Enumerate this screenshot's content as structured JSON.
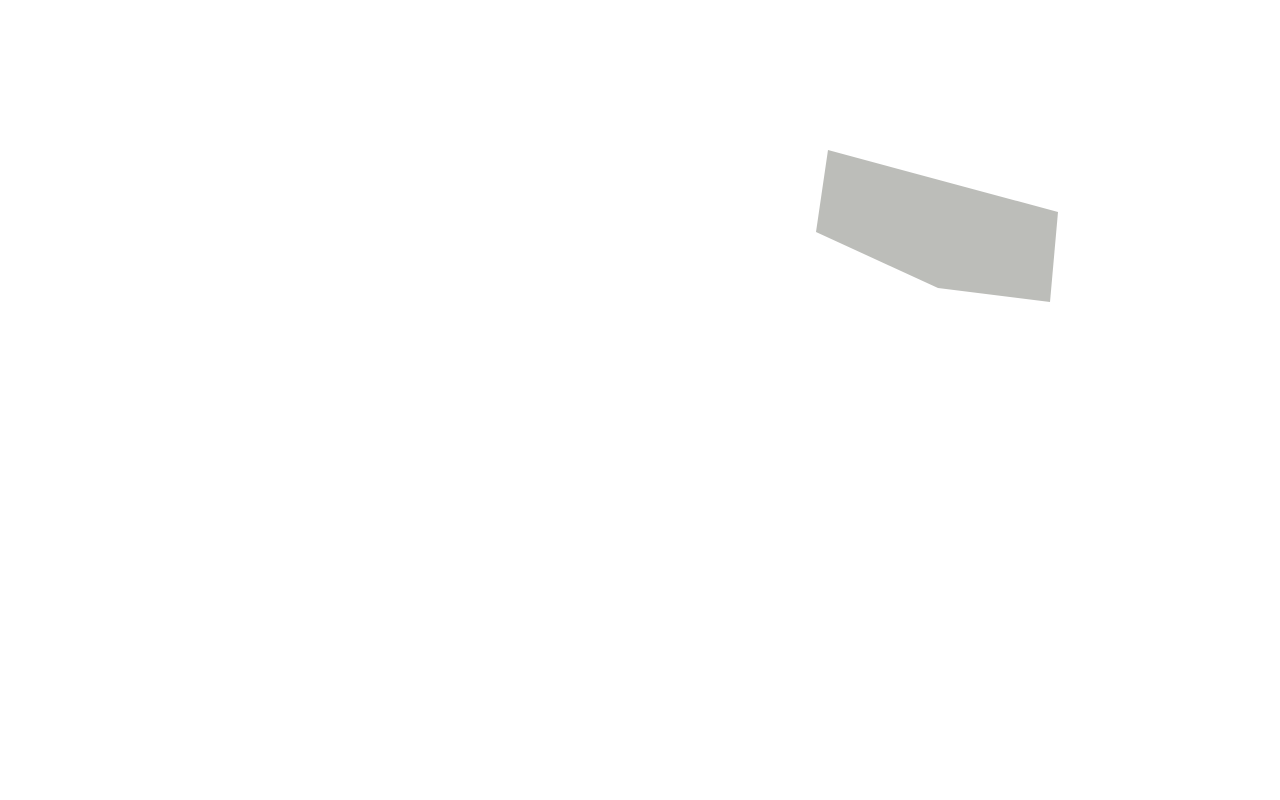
{
  "scene": {
    "kind": "isometric-3d-floor-plan-render",
    "rooms": [
      {
        "name": "garage",
        "floor": "concrete",
        "contents": [
          "car",
          "storage-boxes",
          "windows"
        ]
      },
      {
        "name": "living-room",
        "floor": "wood-planks",
        "accent_wall": "green",
        "contents": [
          "cream-sofa",
          "floor-lamp",
          "desk",
          "office-chair",
          "laptop",
          "glass-doors"
        ]
      },
      {
        "name": "staircase",
        "contents": [
          "winder-stairs",
          "half-walls",
          "window"
        ]
      },
      {
        "name": "bathroom",
        "floor": "blue-pattern-tile",
        "walls": "white-tile"
      },
      {
        "name": "utility-room",
        "floor": "gray-tile",
        "contents": [
          "boiler",
          "washer",
          "storage-shelf"
        ]
      },
      {
        "name": "hallway",
        "floor": "gray-tile",
        "contents": [
          "louvered-doors"
        ]
      },
      {
        "name": "kitchen",
        "floor": "blue-pattern-tile",
        "contents": [
          "tall-unit",
          "counter",
          "gas-cooktop",
          "sink-window-bar",
          "pantry-shelf",
          "desk-nook"
        ]
      },
      {
        "name": "dining-area",
        "floor": "wood-planks",
        "contents": [
          "dining-table",
          "yellow-chairs",
          "plant-centerpiece",
          "sideboard"
        ]
      },
      {
        "name": "lounge",
        "floor": "wood-planks",
        "contents": [
          "yellow-sofa",
          "gray-rug",
          "coffee-table",
          "fireplace",
          "tv-console",
          "brick-wall"
        ]
      },
      {
        "name": "rear-patio",
        "floor": "gravel",
        "contents": [
          "chaise-lounge",
          "chaise-lounge",
          "glass-wall",
          "brick-pillar"
        ]
      },
      {
        "name": "terrace",
        "floor": "concrete",
        "contents": [
          "outdoor-table",
          "wicker-chairs",
          "topiary",
          "planter-bed"
        ]
      },
      {
        "name": "entrance-porch",
        "contents": [
          "front-door",
          "steps",
          "planter",
          "planter"
        ]
      },
      {
        "name": "driveway",
        "floor": "concrete"
      }
    ]
  },
  "palette": {
    "bg": "#ffffff",
    "wallTop": "#f3f5f6",
    "wallSide": "#dde1e4",
    "wallShade": "#c7cdd1",
    "wallDark": "#b9bfc4",
    "woodWall": "#b headstone",
    "woodA": "#b79a7b",
    "woodB": "#a58766",
    "woodC": "#c7ad8c",
    "woodD": "#9a7c5c",
    "woodFloor": "#d9c3a0",
    "woodLine": "#c6ac85",
    "woodTrim": "#b5854e",
    "woodTrimLight": "#d8c49a",
    "concrete": "#a3a8aa",
    "concreteDark": "#8f9496",
    "driveway": "#9aa0a2",
    "terrace": "#a6a8a5",
    "speckle": "#969893",
    "gravel": "#bcbdb9",
    "green": "#8ca23e",
    "greenDark": "#7a8f33",
    "brick": "#8a5540",
    "brickLight": "#9d674e",
    "brickDark": "#74462f",
    "blueTileK": "#97a1bd",
    "blueTileKdot": "#7787b6",
    "blueTileB": "#7282b4",
    "blueTileBdot": "#9aa6cc",
    "grayTile": "#8f9498",
    "grayTileLine": "#83888c",
    "yellow": "#d8a23c",
    "yellowDark": "#bf8c2f",
    "cream": "#eae4d4",
    "creamDark": "#d9d2bf",
    "charcoal": "#55595d",
    "charcoalDark": "#45494d",
    "steel": "#b9bec3",
    "dark": "#2f3338",
    "rug": "#8f9296",
    "rugDark": "#818488",
    "plant": "#4f7038",
    "plantLight": "#6d8c4e",
    "plantDark": "#3c5729",
    "boilerBlue": "#3a68c0",
    "tanBox": "#c8a466",
    "tanBoxDark": "#b28d4e",
    "consoleDark": "#4a4743",
    "fire": "#e8a14d",
    "fireGlow": "#f6c97e",
    "carBody": "#46484b",
    "carRoof": "#55585c",
    "carGlass": "#6e7378",
    "carDark": "#3a3c3f",
    "chairTaupe": "#9a9184",
    "cushion": "#d9d4c7",
    "stone": "#a7a7a3",
    "deck": "#cfc0a6",
    "step1": "#ddd6c9",
    "step2": "#c9c2b4",
    "step3": "#d5cec0",
    "glass": "#ccd3d8",
    "white": "#f6f7f8",
    "planterWood": "#8a6b4a"
  }
}
